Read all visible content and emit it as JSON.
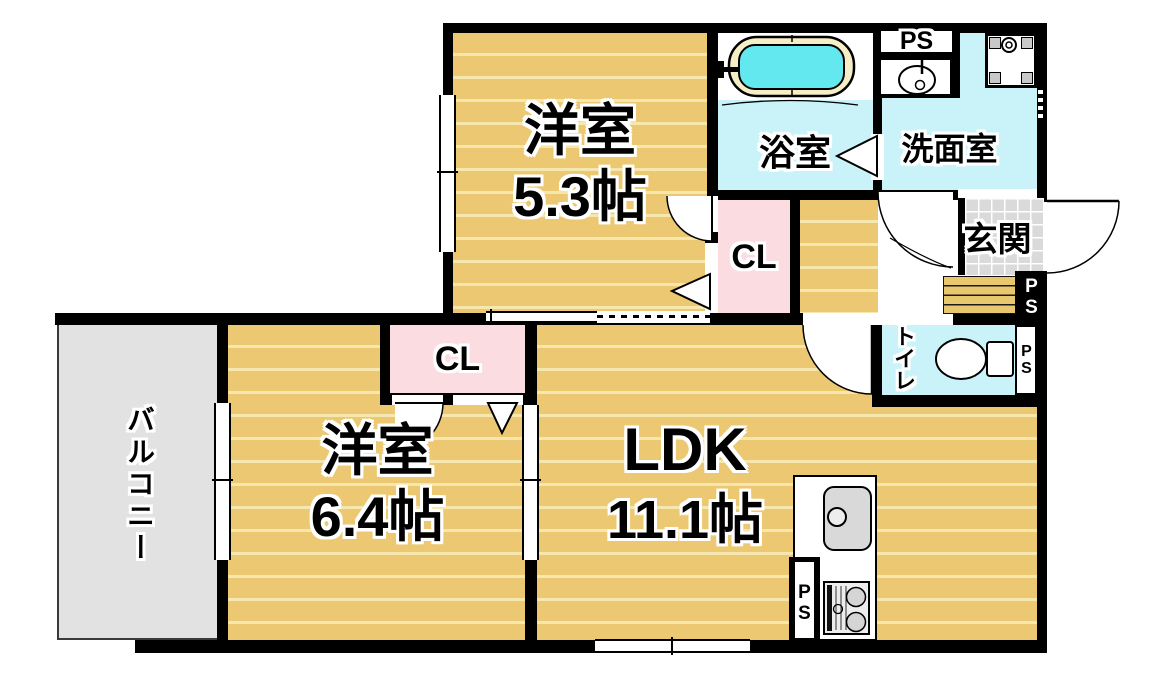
{
  "floorplan": {
    "rooms": {
      "bedroom_upper": {
        "name": "洋室",
        "size": "5.3帖"
      },
      "bedroom_lower": {
        "name": "洋室",
        "size": "6.4帖"
      },
      "ldk": {
        "name": "LDK",
        "size": "11.1帖"
      },
      "bathroom": {
        "name": "浴室"
      },
      "washroom": {
        "name": "洗面室"
      },
      "toilet": {
        "name": "トイレ"
      },
      "entrance": {
        "name": "玄関"
      },
      "balcony": {
        "name": "バルコニー"
      },
      "closet_upper": {
        "name": "CL"
      },
      "closet_lower": {
        "name": "CL"
      }
    },
    "pipe_space_label": "PS",
    "colors": {
      "wall": "#000000",
      "flooring": "#ecc873",
      "flooring_stripe": "#f6e7ae",
      "wet_area": "#c9f3f8",
      "bath_water": "#63e8f0",
      "closet": "#fbdce1",
      "balcony": "#e2e2e2",
      "entrance_tile": "#dadada"
    }
  }
}
